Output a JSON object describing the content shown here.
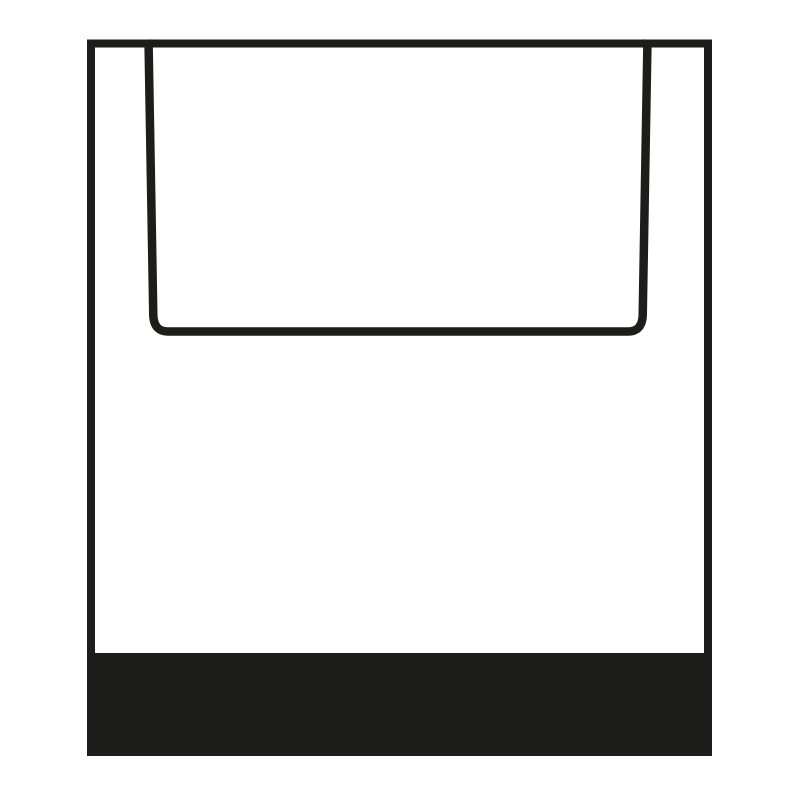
{
  "page": {
    "background": "#ffffff",
    "width": 800,
    "height": 800
  },
  "icon": {
    "name": "open-top-container-glyph",
    "description": "Black pictogram of a square vessel with an inset open-top recess and a solid black base band",
    "ink": "#1d1d1b",
    "background": "#ffffff"
  }
}
